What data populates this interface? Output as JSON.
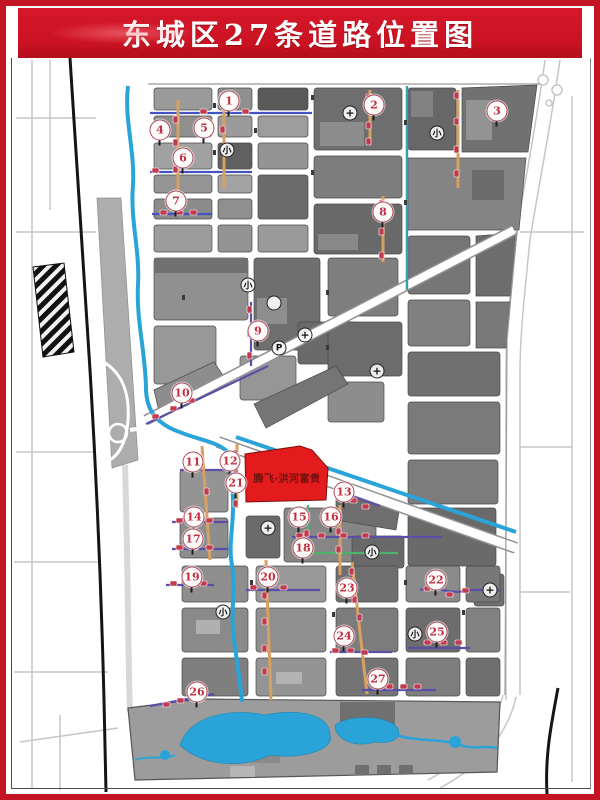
{
  "banner": {
    "title": "东城区27条道路位置图"
  },
  "parcel": {
    "label": "腾飞·洪河富贵"
  },
  "colors": {
    "frame_red": "#c41523",
    "banner_red": "#cb1222",
    "parcel_red": "#e31b1c",
    "parcel_text": "#6e120d",
    "marker_ring": "#b04b5c",
    "marker_number": "#c22f40",
    "water_blue": "#2aa4d8",
    "canal_teal": "#3aa0a8",
    "road_orange": "#d8a060",
    "road_purple": "#5b4ea6",
    "road_blue": "#4353c6",
    "road_green": "#4db36a",
    "chip_red": "#c23a4d",
    "railway_black": "#151515",
    "block_gray_dark": "#696969",
    "block_gray_light": "#9c9c9c"
  },
  "map": {
    "markers": [
      {
        "n": "1",
        "x": 229,
        "y": 101
      },
      {
        "n": "2",
        "x": 374,
        "y": 105
      },
      {
        "n": "3",
        "x": 497,
        "y": 111
      },
      {
        "n": "4",
        "x": 160,
        "y": 130
      },
      {
        "n": "5",
        "x": 204,
        "y": 128
      },
      {
        "n": "6",
        "x": 183,
        "y": 158
      },
      {
        "n": "7",
        "x": 176,
        "y": 201
      },
      {
        "n": "8",
        "x": 383,
        "y": 212
      },
      {
        "n": "9",
        "x": 258,
        "y": 331
      },
      {
        "n": "10",
        "x": 182,
        "y": 393
      },
      {
        "n": "11",
        "x": 193,
        "y": 462
      },
      {
        "n": "12",
        "x": 230,
        "y": 461
      },
      {
        "n": "13",
        "x": 344,
        "y": 492
      },
      {
        "n": "14",
        "x": 194,
        "y": 517
      },
      {
        "n": "15",
        "x": 299,
        "y": 517
      },
      {
        "n": "16",
        "x": 331,
        "y": 517
      },
      {
        "n": "17",
        "x": 193,
        "y": 539
      },
      {
        "n": "18",
        "x": 303,
        "y": 548
      },
      {
        "n": "19",
        "x": 192,
        "y": 577
      },
      {
        "n": "20",
        "x": 268,
        "y": 577
      },
      {
        "n": "21",
        "x": 236,
        "y": 483
      },
      {
        "n": "22",
        "x": 436,
        "y": 580
      },
      {
        "n": "23",
        "x": 347,
        "y": 588
      },
      {
        "n": "24",
        "x": 344,
        "y": 636
      },
      {
        "n": "25",
        "x": 437,
        "y": 632
      },
      {
        "n": "26",
        "x": 197,
        "y": 692
      },
      {
        "n": "27",
        "x": 378,
        "y": 679
      }
    ],
    "pois": [
      {
        "glyph": "小",
        "type": "school",
        "x": 227,
        "y": 150
      },
      {
        "glyph": "小",
        "type": "school",
        "x": 437,
        "y": 133
      },
      {
        "glyph": "小",
        "type": "school",
        "x": 248,
        "y": 285
      },
      {
        "glyph": "小",
        "type": "school",
        "x": 372,
        "y": 552
      },
      {
        "glyph": "小",
        "type": "school",
        "x": 223,
        "y": 612
      },
      {
        "glyph": "小",
        "type": "school",
        "x": 415,
        "y": 634
      },
      {
        "glyph": "+",
        "type": "hospital",
        "x": 350,
        "y": 113
      },
      {
        "glyph": "+",
        "type": "hospital",
        "x": 305,
        "y": 335
      },
      {
        "glyph": "+",
        "type": "hospital",
        "x": 377,
        "y": 371
      },
      {
        "glyph": "+",
        "type": "hospital",
        "x": 268,
        "y": 528
      },
      {
        "glyph": "+",
        "type": "hospital",
        "x": 490,
        "y": 590
      },
      {
        "glyph": "P",
        "type": "parking",
        "x": 279,
        "y": 348
      },
      {
        "glyph": "",
        "type": "landmark",
        "x": 274,
        "y": 303
      }
    ]
  }
}
